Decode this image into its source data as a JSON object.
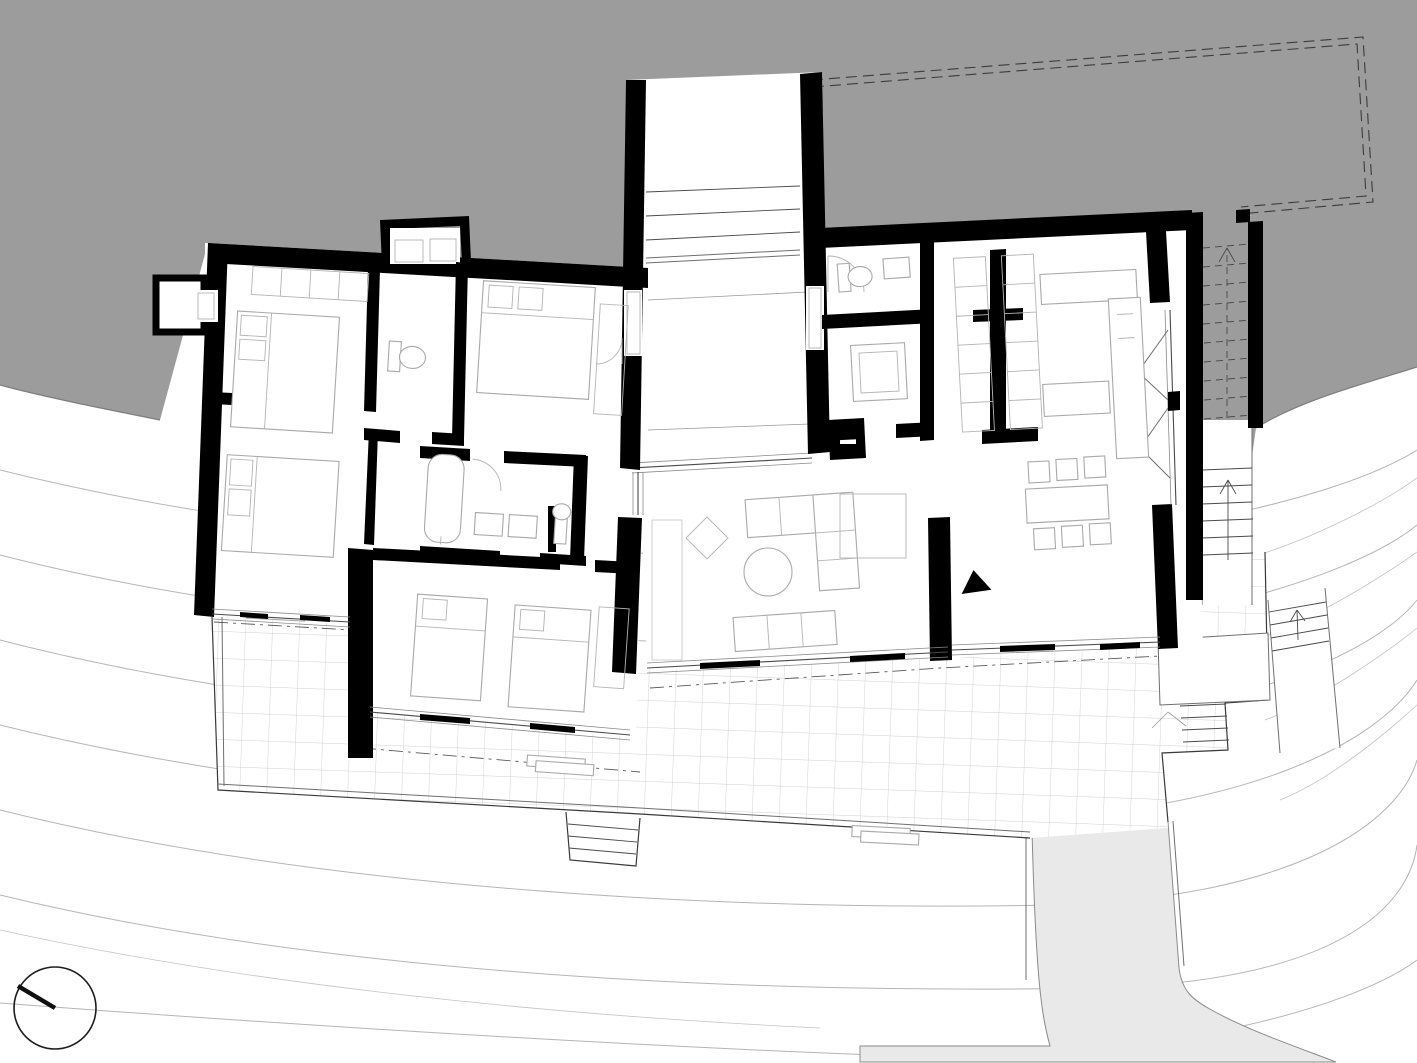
{
  "document": {
    "kind": "architectural-floor-plan",
    "description": "Ground floor plan of a hillside house with two splayed wings, sunken entry court, gridded south terrace, exterior hill stair and driveway",
    "title": "",
    "visible_text": []
  },
  "palette": {
    "background": "#ffffff",
    "hillside_fill": "#9c9c9c",
    "driveway_fill": "#e9e9e9",
    "wall_fill": "#000000",
    "contour_stroke": "#b5b5b5",
    "terrace_grid_stroke": "#d0d0d0",
    "glazing_stroke": "#4a4a4a",
    "furniture_stroke": "#a9a9a9",
    "dashed_roof_outline_stroke": "#3c3c3c"
  },
  "features": {
    "north_arrow": "circle with needle pointing upper-left",
    "entry_court_steps": 4,
    "hill_stair_hidden_treads": 10,
    "hill_stair_open_treads": 6,
    "terrace_south_steps": 5,
    "northeast_corner_steps": 4,
    "east_path_steps": 4,
    "dining_chairs": 6,
    "beds": 5,
    "sofas": 2,
    "bathtub": 1,
    "showers": 1,
    "toilets": 3,
    "sun_loungers": 3,
    "roof_outline": "double dashed rectangle over hillside at top right"
  },
  "aria": {
    "figure_label": "Black and white architectural ground floor plan on a contoured hillside site",
    "compass_label": "North arrow",
    "hill_label": "Hillside cut (gray)",
    "terrace_label": "Paved terrace with grid pattern",
    "driveway_label": "Driveway"
  }
}
